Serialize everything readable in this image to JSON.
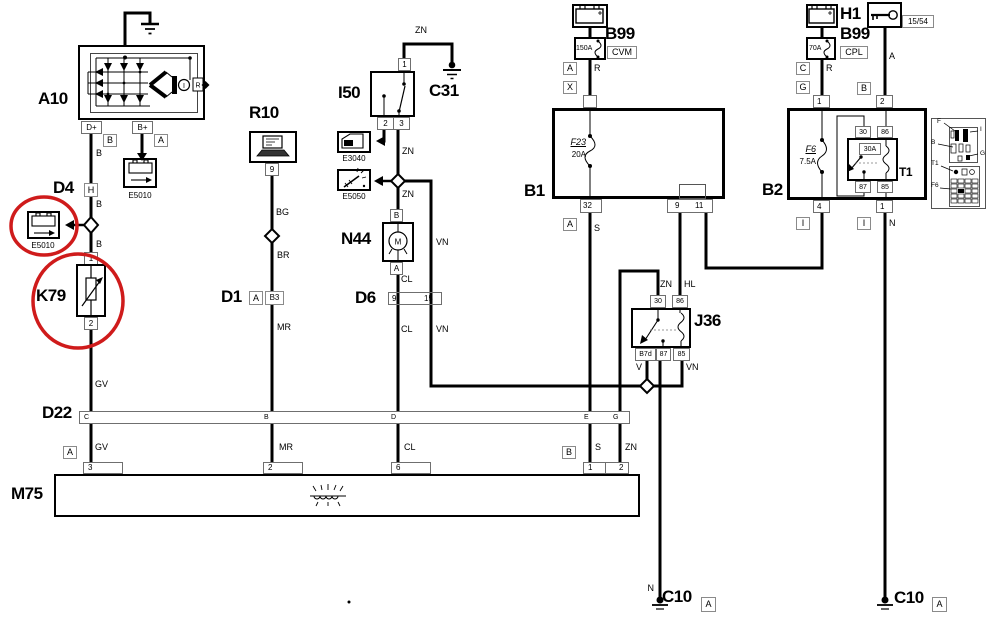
{
  "diagram": {
    "a10": {
      "ref": "A10",
      "pin_dplus": "D+",
      "pin_bplus": "B+",
      "tag_b": "B",
      "tag_a": "A",
      "reg_i": "I",
      "reg_r": "R"
    },
    "e5010_top": {
      "ref": "E5010"
    },
    "d4": {
      "ref": "D4",
      "tag_h": "H"
    },
    "e5010_side": {
      "ref": "E5010"
    },
    "k79": {
      "ref": "K79",
      "pin1": "1",
      "pin2": "2"
    },
    "r10": {
      "ref": "R10",
      "pin9": "9"
    },
    "d1": {
      "ref": "D1",
      "tag_a": "A",
      "tag_b3": "B3"
    },
    "i50": {
      "ref": "I50",
      "pin1": "1",
      "pin2": "2",
      "pin3": "3"
    },
    "c31": {
      "ref": "C31"
    },
    "e3040": {
      "ref": "E3040"
    },
    "e5050": {
      "ref": "E5050"
    },
    "n44": {
      "ref": "N44",
      "tag_b": "B",
      "tag_a": "A",
      "motor": "M"
    },
    "d6": {
      "ref": "D6",
      "pin9": "9",
      "pin15": "15"
    },
    "b99_center": {
      "ref": "B99",
      "code": "CVM",
      "fuse": "150A",
      "tag_a": "A",
      "tag_x": "X"
    },
    "b1": {
      "ref": "B1",
      "fuse": "F23",
      "rating": "20A",
      "pin32": "32",
      "pin9": "9",
      "pin11": "11",
      "tag_a": "A"
    },
    "h1": {
      "ref": "H1",
      "terminal": "15/54"
    },
    "b99_right": {
      "ref": "B99",
      "code": "CPL",
      "fuse": "70A",
      "tag_c": "C",
      "tag_g": "G"
    },
    "b2": {
      "ref": "B2",
      "fuse": "F6",
      "rating": "7.5A",
      "pin_top_1": "1",
      "pin_top_2": "2",
      "pin_bot_4": "4",
      "pin_bot_1": "1",
      "tag_b": "B",
      "tag_i1": "I",
      "tag_i2": "I"
    },
    "t1": {
      "ref": "T1",
      "p30": "30",
      "p86": "86",
      "p87": "87",
      "p85": "85",
      "rating": "30A"
    },
    "j36": {
      "ref": "J36",
      "p30": "30",
      "p86": "86",
      "pb7d": "B7d",
      "p87": "87",
      "p85": "85"
    },
    "d22": {
      "ref": "D22",
      "tag_a": "A",
      "tag_b": "B",
      "pins": [
        "C",
        "B",
        "D",
        "E",
        "G"
      ]
    },
    "m75": {
      "ref": "M75",
      "pin3": "3",
      "pin2": "2",
      "pin6": "6",
      "pin1": "1",
      "pin2b": "2"
    },
    "c10_center": {
      "ref": "C10",
      "tag_a": "A"
    },
    "c10_right": {
      "ref": "C10",
      "tag_a": "A"
    },
    "wires": {
      "b1": "B",
      "b2": "B",
      "b3": "B",
      "gv1": "GV",
      "gv2": "GV",
      "bg": "BG",
      "br": "BR",
      "mr1": "MR",
      "mr2": "MR",
      "zn_c31": "ZN",
      "zn_i50": "ZN",
      "zn_n44": "ZN",
      "zn_j36": "ZN",
      "zn_d22": "ZN",
      "cl1": "CL",
      "cl2": "CL",
      "cl3": "CL",
      "vn1": "VN",
      "vn2": "VN",
      "vn3": "VN",
      "v": "V",
      "r1": "R",
      "r2": "R",
      "a1": "A",
      "s1": "S",
      "s2": "S",
      "hl": "HL",
      "n1": "N",
      "n2": "N"
    },
    "legend": {
      "f": "F",
      "i": "I",
      "b": "B",
      "g": "G",
      "t1": "T1",
      "f6": "F6"
    },
    "colors": {
      "wire": "#000000",
      "highlight": "#cf1b1b"
    }
  }
}
